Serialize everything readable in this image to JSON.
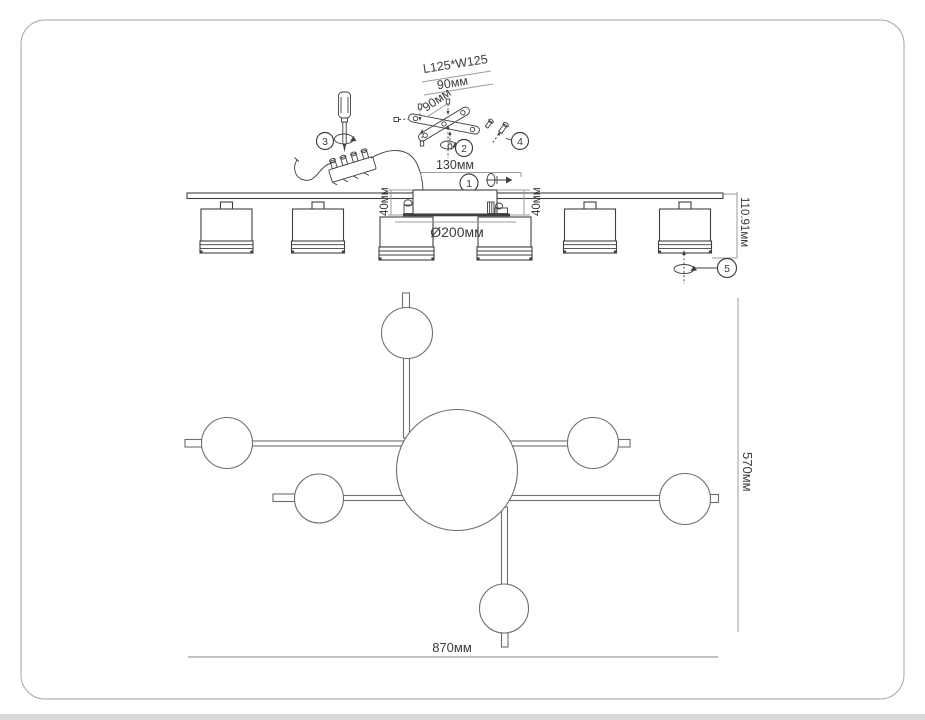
{
  "steps": {
    "s1": "1",
    "s2": "2",
    "s3": "3",
    "s4": "4",
    "s5": "5"
  },
  "dimensions": {
    "bracket_plate": "L125*W125",
    "bracket_width": "90мм",
    "bracket_depth": "90мм",
    "canopy_width": "130мм",
    "drop_left": "40мм",
    "drop_right": "40мм",
    "shade_diameter": "Ø200мм",
    "fixture_height": "110.91мм",
    "plan_length": "870мм",
    "plan_depth": "570мм"
  },
  "colors": {
    "line": "#3f3f3f",
    "plan": "#6e6e6e",
    "dim": "#9b9b9b",
    "dim2": "#b9b9b9",
    "text": "#3c3c3c",
    "frame": "#a6a6a6",
    "band": "#d9d9d9"
  }
}
